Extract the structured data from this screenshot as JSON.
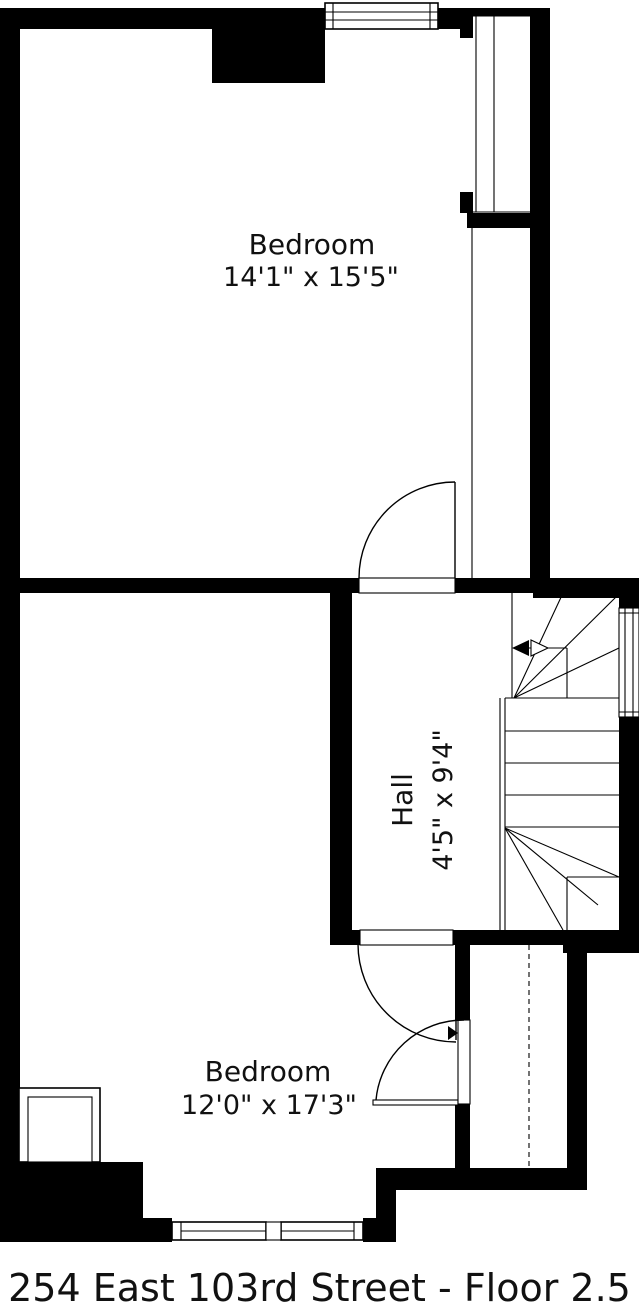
{
  "floor_plan": {
    "rooms": [
      {
        "name": "Bedroom",
        "dimensions": "14'1\" x 15'5\""
      },
      {
        "name": "Hall",
        "dimensions": "4'5\" x 9'4\""
      },
      {
        "name": "Bedroom",
        "dimensions": "12'0\" x 17'3\""
      }
    ],
    "caption": "254 East 103rd Street - Floor 2.5",
    "colors": {
      "wall": "#000000",
      "background": "#ffffff",
      "text": "#111111"
    }
  }
}
